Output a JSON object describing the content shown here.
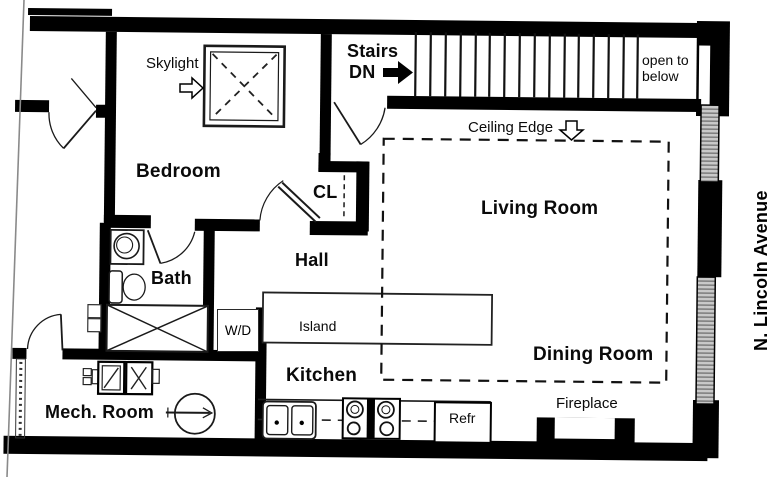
{
  "plan": {
    "rooms": {
      "bedroom": "Bedroom",
      "bath": "Bath",
      "hall": "Hall",
      "closet": "CL",
      "kitchen": "Kitchen",
      "living_room": "Living Room",
      "dining_room": "Dining Room",
      "mech_room": "Mech. Room"
    },
    "features": {
      "skylight": "Skylight",
      "stairs_line1": "Stairs",
      "stairs_line2": "DN",
      "open_to_below": "open to below",
      "ceiling_edge": "Ceiling Edge",
      "island": "Island",
      "washer_dryer": "W/D",
      "refrigerator": "Refr",
      "fireplace": "Fireplace"
    },
    "street": "N. Lincoln Avenue",
    "icons": [
      "stairs-dn-arrow-icon",
      "skylight-arrow-icon",
      "ceiling-edge-arrow-icon",
      "skylight-icon",
      "stair-treads-icon",
      "door-swing-icon",
      "tub-icon",
      "toilet-icon",
      "bath-sink-icon",
      "kitchen-sink-icon",
      "stove-icon",
      "refrigerator-icon",
      "water-heater-icon",
      "furnace-icon",
      "fireplace-icon",
      "window-icon"
    ],
    "colors": {
      "wall": "#000000",
      "paper": "#ffffff",
      "page_edge": "#8a8a8a",
      "window_fill": "#cccccc"
    }
  }
}
